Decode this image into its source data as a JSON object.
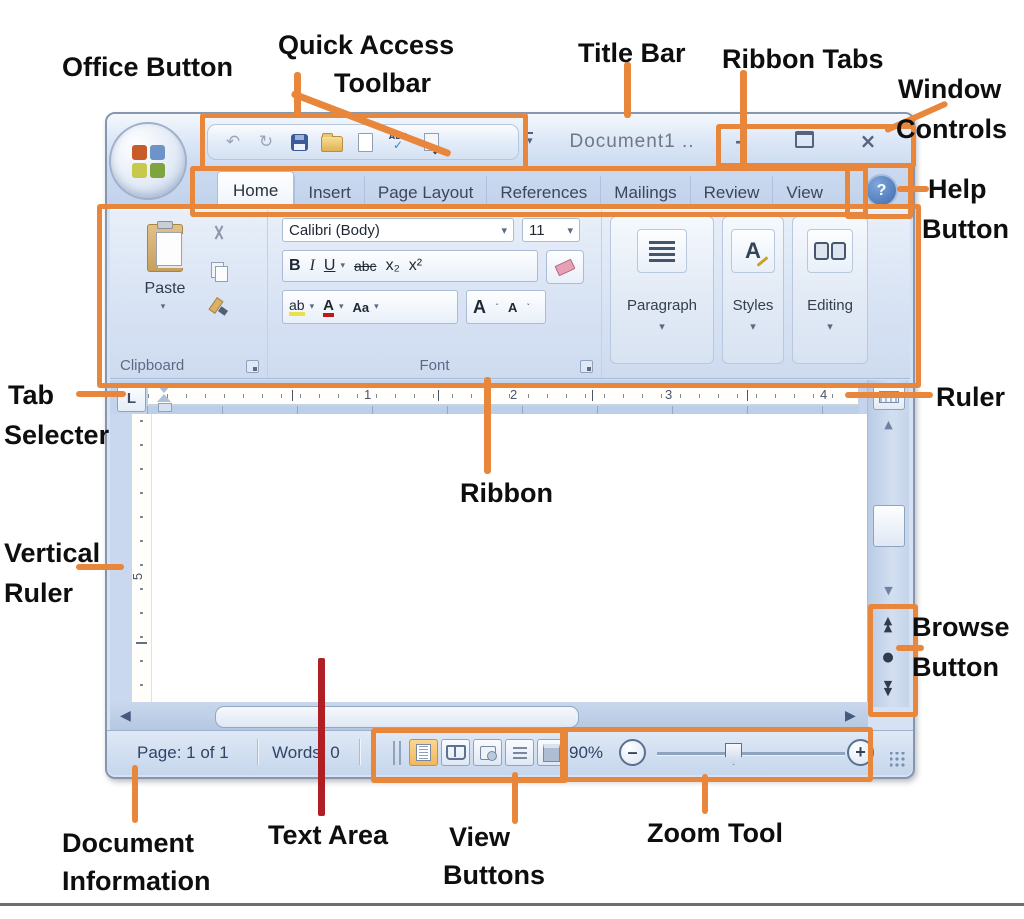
{
  "annotations": {
    "office_button": "Office Button",
    "quick_access": [
      "Quick Access",
      "Toolbar"
    ],
    "title_bar": "Title Bar",
    "ribbon_tabs": "Ribbon Tabs",
    "window_controls": [
      "Window",
      "Controls"
    ],
    "help_button": [
      "Help",
      "Button"
    ],
    "tab_selecter": [
      "Tab",
      "Selecter"
    ],
    "ribbon": "Ribbon",
    "ruler": "Ruler",
    "vertical_ruler": [
      "Vertical",
      "Ruler"
    ],
    "browse_button": [
      "Browse",
      "Button"
    ],
    "document_information": [
      "Document",
      "Information"
    ],
    "text_area": "Text Area",
    "view_buttons": [
      "View",
      "Buttons"
    ],
    "zoom_tool": "Zoom Tool"
  },
  "window": {
    "title": "Document1 ..",
    "tabs": [
      "Home",
      "Insert",
      "Page Layout",
      "References",
      "Mailings",
      "Review",
      "View"
    ],
    "active_tab": "Home",
    "ribbon": {
      "clipboard": {
        "paste": "Paste",
        "label": "Clipboard"
      },
      "font": {
        "name": "Calibri (Body)",
        "size": "11",
        "bold": "B",
        "italic": "I",
        "underline": "U",
        "strikethrough": "abc",
        "subscript": "x₂",
        "superscript": "x²",
        "highlight": "ab",
        "color": "A",
        "change_case": "Aa",
        "grow": "A",
        "shrink": "A",
        "label": "Font"
      },
      "paragraph_label": "Paragraph",
      "styles_label": "Styles",
      "styles_letter": "A",
      "editing_label": "Editing"
    },
    "ruler_numbers": [
      "1",
      "2",
      "3",
      "4"
    ],
    "vertical_ruler_number": "5",
    "status": {
      "page": "Page: 1 of 1",
      "words": "Words: 0",
      "zoom": "90%"
    }
  },
  "glyphs": {
    "undo": "↶",
    "redo": "↻",
    "dropdown": "▾",
    "minimize": "–",
    "close": "×",
    "help": "?",
    "spelling_abc": "ABC",
    "check": "✓",
    "scroll_left": "◀",
    "scroll_right": "▶",
    "scroll_up": "▲",
    "scroll_down": "▼",
    "browse_up": "▲",
    "browse_circle": "●",
    "browse_down": "▼",
    "zoom_out": "–",
    "zoom_in": "+",
    "tab_selector": "L"
  },
  "colors": {
    "annotation_orange": "#E8873C",
    "pointer_red": "#AF1F24",
    "chrome_blue": "#D6E2F3",
    "active_view_button": "#F2B75C"
  }
}
